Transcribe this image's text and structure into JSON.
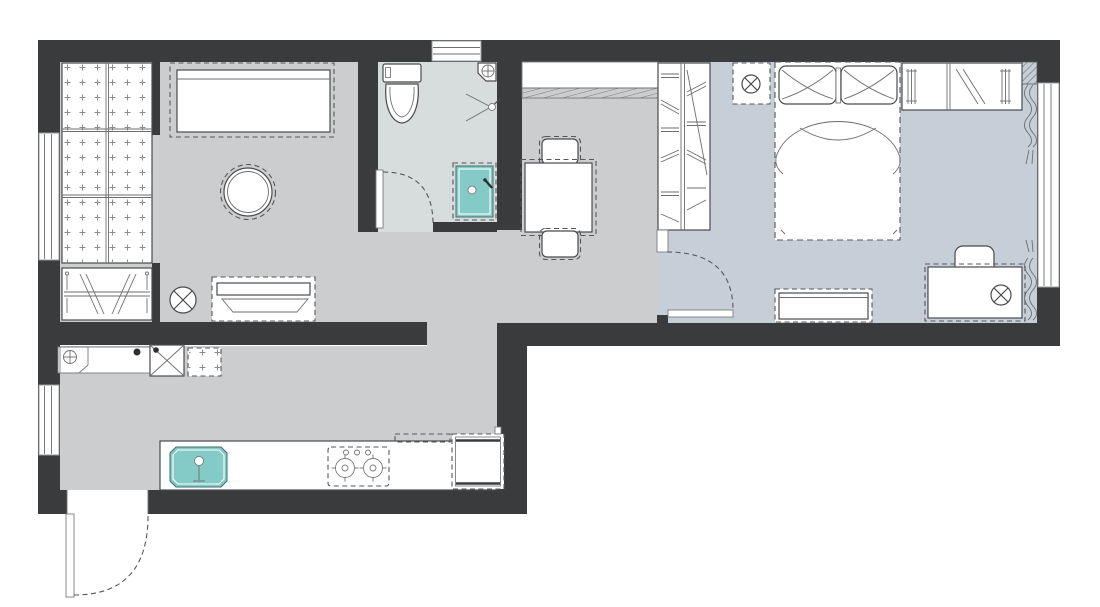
{
  "meta": {
    "kind": "apartment-floor-plan",
    "orientation": "landscape"
  },
  "colors": {
    "background": "#ffffff",
    "wall": "#3a3b3d",
    "floor": "#cccdce",
    "floor_bedroom": "#c6cfd8",
    "floor_bathroom": "#d7dcdd",
    "accent": "#84cbc8",
    "line": "#4a4b4d"
  },
  "rooms": [
    {
      "name": "living-room",
      "floor_color": "#cccdce"
    },
    {
      "name": "bathroom",
      "floor_color": "#d7dcdd"
    },
    {
      "name": "hall-dining",
      "floor_color": "#cccdce"
    },
    {
      "name": "bedroom",
      "floor_color": "#c6cfd8"
    },
    {
      "name": "kitchen",
      "floor_color": "#cccdce"
    }
  ],
  "furniture": {
    "living_room": [
      "tatami-platform",
      "hanging-rail",
      "sofa",
      "round-table",
      "floor-lamp",
      "storage-bench"
    ],
    "bathroom": [
      "toilet",
      "corner-basin",
      "shower-mixer",
      "shower-tray",
      "door-swing"
    ],
    "dining": [
      "wall-shelf",
      "dining-table",
      "chair-north",
      "chair-south"
    ],
    "bedroom": [
      "wardrobe",
      "nightstand-lamp",
      "double-bed",
      "overhead-closet",
      "curtains",
      "desk",
      "desk-chair",
      "desk-lamp",
      "dresser",
      "door-swing"
    ],
    "kitchen": [
      "boiler-unit",
      "washing-machine",
      "stool",
      "worktop",
      "sink",
      "hob-two-burners",
      "hood",
      "fridge",
      "entrance-door-swing"
    ]
  },
  "windows": [
    "top-window",
    "left-window-upper",
    "left-window-lower",
    "right-window"
  ]
}
